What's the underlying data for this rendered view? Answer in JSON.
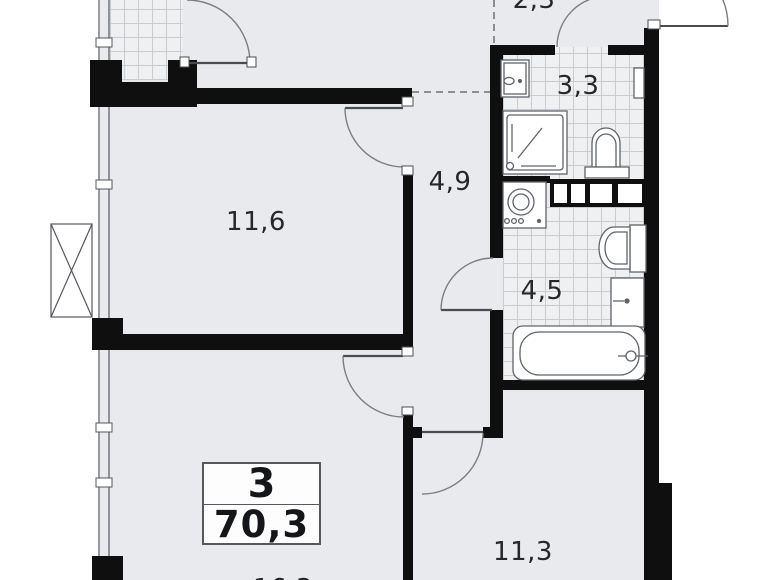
{
  "plan": {
    "title": "apartment-floor-plan",
    "summary": {
      "rooms_count": "3",
      "total_area": "70,3"
    },
    "room_labels": [
      {
        "name": "room-top-left",
        "area": "11,6"
      },
      {
        "name": "hallway",
        "area": "4,9"
      },
      {
        "name": "bathroom-top",
        "area": "3,3"
      },
      {
        "name": "entry-zone",
        "area": "2,3"
      },
      {
        "name": "bathroom-bottom",
        "area": "4,5"
      },
      {
        "name": "room-bottom-right",
        "area": "11,3"
      },
      {
        "name": "living-room-partial",
        "area": "16,3"
      }
    ],
    "fixtures": [
      "sink",
      "shower-tray",
      "toilet",
      "towel-radiator",
      "vent-duct",
      "washing-machine",
      "toilet-2",
      "sink-2",
      "bathtub"
    ],
    "colors": {
      "floor": "#e8eaed",
      "wall": "#0f0f10",
      "fixture_line": "#5f646a",
      "tile_line": "#c7ccd1"
    }
  }
}
